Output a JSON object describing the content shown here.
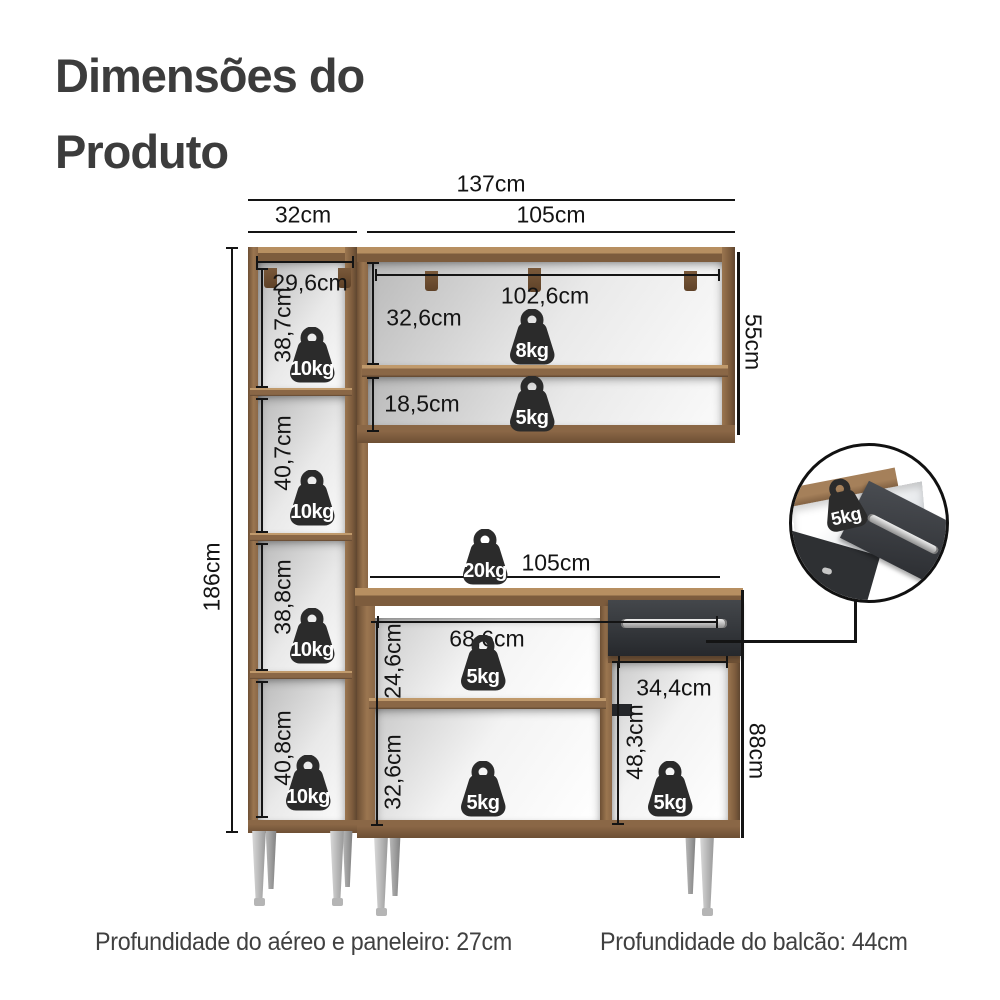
{
  "title": {
    "line1": "Dimensões do",
    "line2": "Produto"
  },
  "dims": {
    "total_width": "137cm",
    "tower_width": "32cm",
    "right_width_top": "105cm",
    "tower_inner_width": "29,6cm",
    "aereo_inner_width": "102,6cm",
    "aereo_shelf_top_height": "32,6cm",
    "aereo_shelf_bottom_height": "18,5cm",
    "aereo_height": "55cm",
    "tower_section1": "38,7cm",
    "tower_section2": "40,7cm",
    "tower_section3": "38,8cm",
    "tower_section4": "40,8cm",
    "tower_height": "186cm",
    "balcao_width": "105cm",
    "balcao_inner_width": "68,6cm",
    "balcao_section_top": "24,6cm",
    "balcao_section_bottom": "32,6cm",
    "balcao_right_width": "34,4cm",
    "balcao_right_height": "48,3cm",
    "balcao_height": "88cm"
  },
  "weights": {
    "tower1": "10kg",
    "tower2": "10kg",
    "tower3": "10kg",
    "tower4": "10kg",
    "aereo_top": "8kg",
    "aereo_bottom": "5kg",
    "balcao_top": "20kg",
    "balcao_shelf": "5kg",
    "balcao_bottom": "5kg",
    "balcao_right": "5kg",
    "drawer_detail": "5kg"
  },
  "footer": {
    "left": "Profundidade do aéreo e paneleiro: 27cm",
    "right": "Profundidade do balcão: 44cm"
  },
  "colors": {
    "wood": "#8a6746",
    "wood_light": "#b78f61",
    "wood_dark": "#6d4f34",
    "drawer_front": "#34373b",
    "weight_icon": "#2b2b2b",
    "dimension_line": "#141414",
    "text": "#3c3c3c",
    "leg": "#bdbdbd"
  }
}
